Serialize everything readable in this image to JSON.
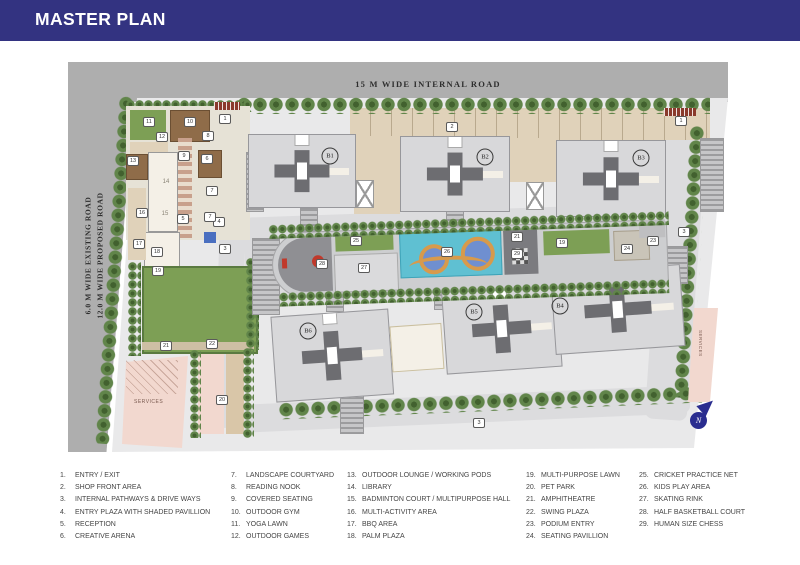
{
  "header": {
    "title": "MASTER PLAN"
  },
  "plan": {
    "top_road_label": "15 M WIDE INTERNAL ROAD",
    "left_road_label_line1": "6.0 M WIDE EXISTING ROAD",
    "left_road_label_line2": "12.0 M WIDE PROPOSED ROAD",
    "services_label_left": "SERVICES",
    "services_label_right": "SERVICES",
    "compass_label": "N",
    "buildings": [
      {
        "label": "B1",
        "x": 330,
        "y": 156
      },
      {
        "label": "B2",
        "x": 485,
        "y": 157
      },
      {
        "label": "B3",
        "x": 641,
        "y": 158
      },
      {
        "label": "B4",
        "x": 560,
        "y": 306
      },
      {
        "label": "B5",
        "x": 474,
        "y": 312
      },
      {
        "label": "B6",
        "x": 308,
        "y": 331
      }
    ],
    "markers": [
      {
        "n": "1",
        "x": 225,
        "y": 119
      },
      {
        "n": "1",
        "x": 681,
        "y": 121
      },
      {
        "n": "2",
        "x": 452,
        "y": 127
      },
      {
        "n": "3",
        "x": 225,
        "y": 249
      },
      {
        "n": "3",
        "x": 684,
        "y": 232
      },
      {
        "n": "3",
        "x": 479,
        "y": 423
      },
      {
        "n": "4",
        "x": 219,
        "y": 222
      },
      {
        "n": "5",
        "x": 183,
        "y": 219
      },
      {
        "n": "6",
        "x": 207,
        "y": 159
      },
      {
        "n": "7",
        "x": 212,
        "y": 191
      },
      {
        "n": "7",
        "x": 210,
        "y": 217
      },
      {
        "n": "8",
        "x": 208,
        "y": 136
      },
      {
        "n": "9",
        "x": 184,
        "y": 156
      },
      {
        "n": "10",
        "x": 190,
        "y": 122
      },
      {
        "n": "11",
        "x": 149,
        "y": 122
      },
      {
        "n": "12",
        "x": 162,
        "y": 137
      },
      {
        "n": "13",
        "x": 133,
        "y": 161
      },
      {
        "n": "14",
        "x": 166,
        "y": 182,
        "plain": true
      },
      {
        "n": "15",
        "x": 165,
        "y": 214,
        "plain": true
      },
      {
        "n": "16",
        "x": 142,
        "y": 213
      },
      {
        "n": "17",
        "x": 139,
        "y": 244
      },
      {
        "n": "18",
        "x": 157,
        "y": 252
      },
      {
        "n": "19",
        "x": 158,
        "y": 271
      },
      {
        "n": "19",
        "x": 562,
        "y": 243
      },
      {
        "n": "20",
        "x": 222,
        "y": 400
      },
      {
        "n": "21",
        "x": 517,
        "y": 237
      },
      {
        "n": "21",
        "x": 166,
        "y": 346
      },
      {
        "n": "22",
        "x": 212,
        "y": 344
      },
      {
        "n": "23",
        "x": 653,
        "y": 241
      },
      {
        "n": "24",
        "x": 627,
        "y": 249
      },
      {
        "n": "25",
        "x": 356,
        "y": 241
      },
      {
        "n": "26",
        "x": 447,
        "y": 252
      },
      {
        "n": "27",
        "x": 364,
        "y": 268
      },
      {
        "n": "28",
        "x": 322,
        "y": 264
      },
      {
        "n": "29",
        "x": 517,
        "y": 254
      }
    ]
  },
  "legend": {
    "columns": [
      [
        {
          "n": "1.",
          "label": "ENTRY / EXIT"
        },
        {
          "n": "2.",
          "label": "SHOP FRONT AREA"
        },
        {
          "n": "3.",
          "label": "INTERNAL PATHWAYS & DRIVE WAYS"
        },
        {
          "n": "4.",
          "label": "ENTRY PLAZA WITH SHADED PAVILLION"
        },
        {
          "n": "5.",
          "label": "RECEPTION"
        },
        {
          "n": "6.",
          "label": "CREATIVE ARENA"
        }
      ],
      [
        {
          "n": "7.",
          "label": "LANDSCAPE COURTYARD"
        },
        {
          "n": "8.",
          "label": "READING NOOK"
        },
        {
          "n": "9.",
          "label": "COVERED SEATING"
        },
        {
          "n": "10.",
          "label": "OUTDOOR GYM"
        },
        {
          "n": "11.",
          "label": "YOGA LAWN"
        },
        {
          "n": "12.",
          "label": "OUTDOOR GAMES"
        }
      ],
      [
        {
          "n": "13.",
          "label": "OUTDOOR LOUNGE / WORKING PODS"
        },
        {
          "n": "14.",
          "label": "LIBRARY"
        },
        {
          "n": "15.",
          "label": "BADMINTON COURT / MULTIPURPOSE HALL"
        },
        {
          "n": "16.",
          "label": "MULTI-ACTIVITY AREA"
        },
        {
          "n": "17.",
          "label": "BBQ AREA"
        },
        {
          "n": "18.",
          "label": "PALM PLAZA"
        }
      ],
      [
        {
          "n": "19.",
          "label": "MULTI-PURPOSE LAWN"
        },
        {
          "n": "20.",
          "label": "PET PARK"
        },
        {
          "n": "21.",
          "label": "AMPHITHEATRE"
        },
        {
          "n": "22.",
          "label": "SWING PLAZA"
        },
        {
          "n": "23.",
          "label": "PODIUM ENTRY"
        },
        {
          "n": "24.",
          "label": "SEATING PAVILLION"
        }
      ],
      [
        {
          "n": "25.",
          "label": "CRICKET PRACTICE NET"
        },
        {
          "n": "26.",
          "label": "KIDS PLAY AREA"
        },
        {
          "n": "27.",
          "label": "SKATING RINK"
        },
        {
          "n": "28.",
          "label": "HALF BASKETBALL COURT"
        },
        {
          "n": "29.",
          "label": "HUMAN SIZE CHESS"
        }
      ]
    ],
    "column_lefts": [
      60,
      231,
      347,
      526,
      639
    ]
  },
  "colors": {
    "header": "#333381",
    "road": "#aeaeae",
    "ground": "#e9e9ea",
    "building": "#d8d8da",
    "buildingCore": "#6d6d71",
    "tree": "#61854a",
    "treeDark": "#42612f",
    "lawn": "#7d9f55",
    "tan": "#e0d2ba",
    "pool": "#5fc0d2",
    "poolRing": "#d79a4c",
    "poolCircle": "#6f8fd0",
    "services": "#f2d8cf",
    "gate": "#8a3a2c",
    "compass": "#2a2d8f",
    "deck": "#8f6c49",
    "cream": "#f4f0e7",
    "text": "#454545"
  }
}
